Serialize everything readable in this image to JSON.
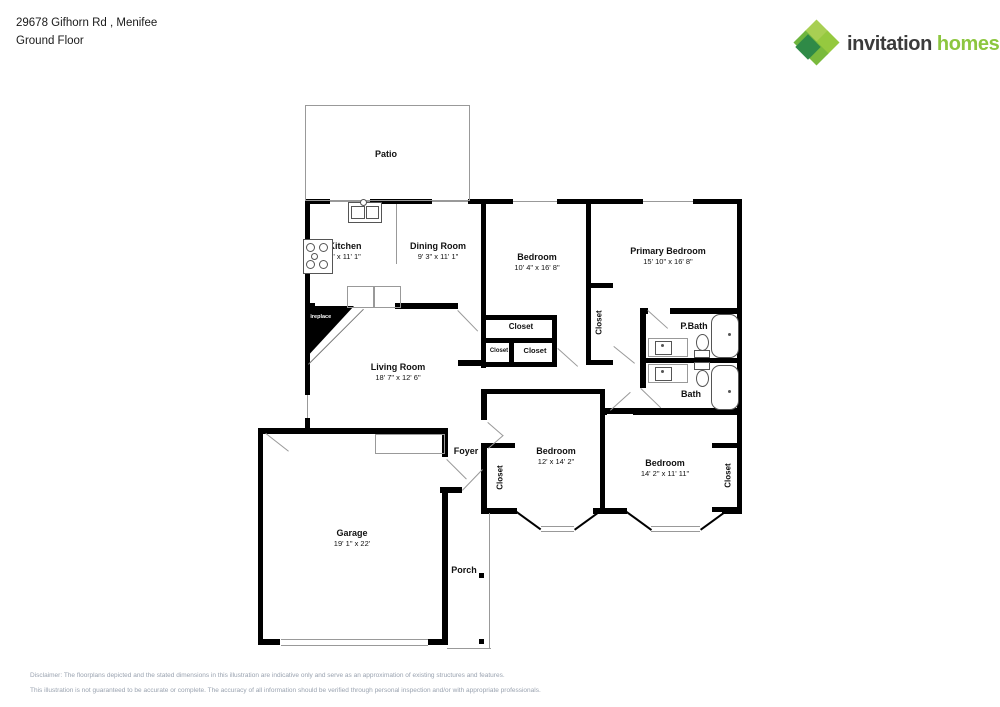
{
  "header": {
    "address": "29678 Gifhorn Rd , Menifee",
    "floor": "Ground Floor"
  },
  "logo": {
    "brand_first": "invitation",
    "brand_second": "homes",
    "trademark": "™",
    "icon": "pinwheel-leaf-icon",
    "colors": {
      "brand_dark": "#3b3b3b",
      "brand_green": "#8cc63f",
      "leaf_light": "#a8cf53",
      "leaf_dark": "#2f8a47"
    }
  },
  "floorplan": {
    "wall_color": "#000000",
    "rooms": {
      "patio": {
        "name": "Patio"
      },
      "kitchen": {
        "name": "Kitchen",
        "dims": "9' x 11' 1\""
      },
      "dining": {
        "name": "Dining Room",
        "dims": "9' 3\" x 11' 1\""
      },
      "bedroom_top": {
        "name": "Bedroom",
        "dims": "10' 4\" x 16' 8\""
      },
      "primary": {
        "name": "Primary Bedroom",
        "dims": "15' 10\" x 16' 8\""
      },
      "closet_a": {
        "name": "Closet"
      },
      "closet_b": {
        "name": "Closet"
      },
      "closet_c": {
        "name": "Closet"
      },
      "closet_primary": {
        "name": "Closet"
      },
      "pbath": {
        "name": "P.Bath"
      },
      "bath": {
        "name": "Bath"
      },
      "fireplace": {
        "name": "Fireplace"
      },
      "living": {
        "name": "Living Room",
        "dims": "18' 7\" x 12' 6\""
      },
      "foyer": {
        "name": "Foyer"
      },
      "closet_foyer": {
        "name": "Closet"
      },
      "bedroom_left": {
        "name": "Bedroom",
        "dims": "12' x 14' 2\""
      },
      "bedroom_right": {
        "name": "Bedroom",
        "dims": "14' 2\" x 11' 11\""
      },
      "closet_bed2": {
        "name": "Closet"
      },
      "garage": {
        "name": "Garage",
        "dims": "19' 1\" x 22'"
      },
      "porch": {
        "name": "Porch"
      }
    }
  },
  "disclaimer": {
    "line1": "Disclaimer: The floorplans depicted and the stated dimensions in this illustration are indicative only and serve as an approximation of existing structures and features.",
    "line2": "This illustration is not guaranteed to be accurate or complete. The accuracy of all information should be verified through personal inspection and/or with appropriate professionals."
  }
}
